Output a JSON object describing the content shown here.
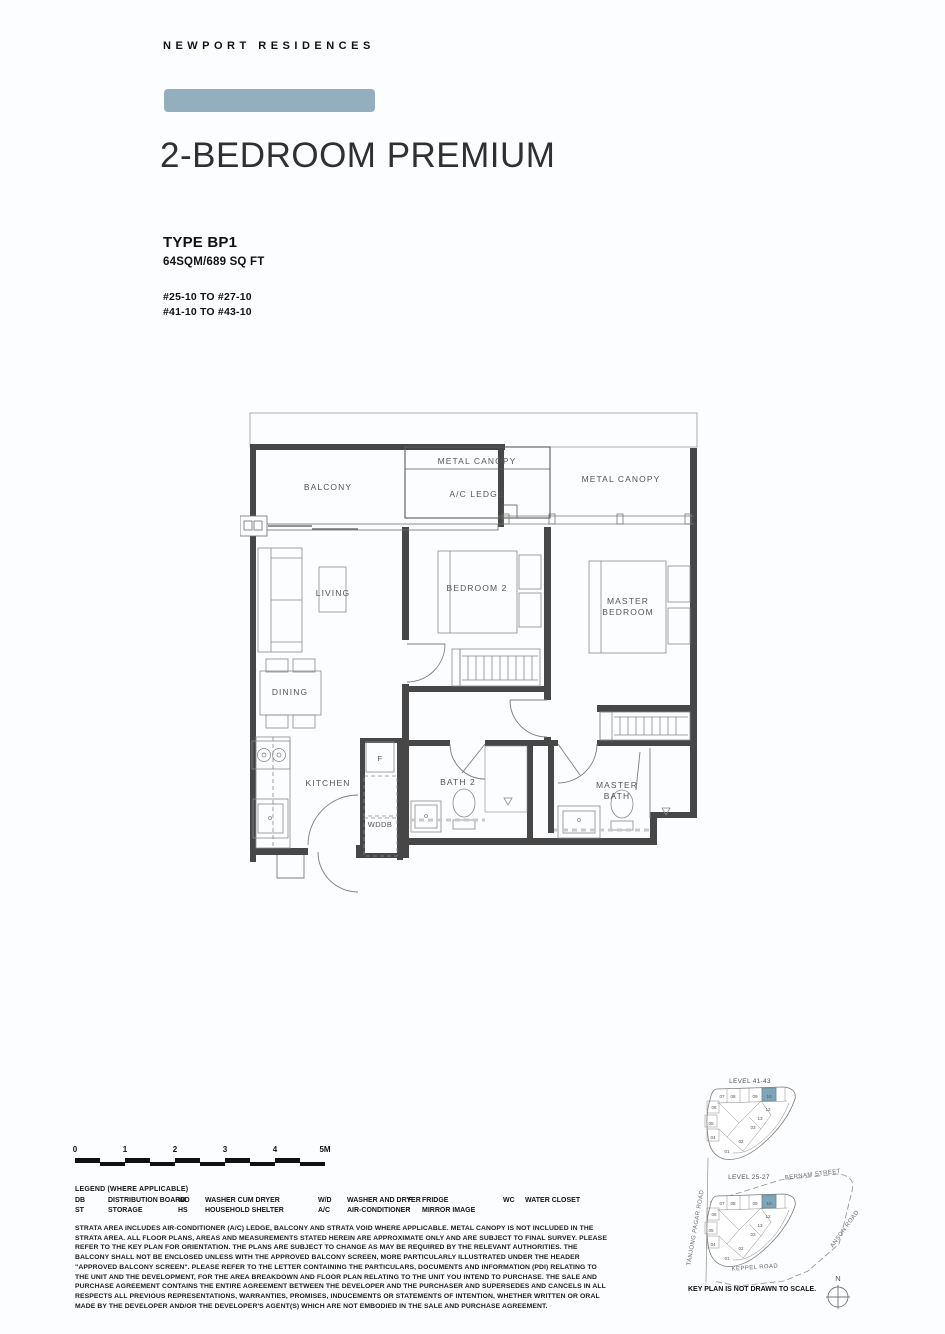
{
  "brand": {
    "name": "NEWPORT RESIDENCES"
  },
  "title": "2-BEDROOM PREMIUM",
  "unit": {
    "type": "TYPE BP1",
    "area": "64SQM/689 SQ FT",
    "stack_lines": [
      "#25-10 TO #27-10",
      "#41-10 TO #43-10"
    ]
  },
  "floorplan": {
    "labels": {
      "metal_canopy_left": "METAL CANOPY",
      "ac_ledge": "A/C LEDGE",
      "metal_canopy_right": "METAL CANOPY",
      "balcony": "BALCONY",
      "living": "LIVING",
      "bedroom2": "BEDROOM 2",
      "master_bedroom_line1": "MASTER",
      "master_bedroom_line2": "BEDROOM",
      "dining": "DINING",
      "kitchen": "KITCHEN",
      "fridge": "F",
      "wddb": "WDDB",
      "bath2": "BATH 2",
      "master_bath_line1": "MASTER",
      "master_bath_line2": "BATH"
    }
  },
  "scalebar": {
    "ticks": [
      "0",
      "1",
      "2",
      "3",
      "4",
      "5M"
    ]
  },
  "legend": {
    "title": "LEGEND (WHERE APPLICABLE)",
    "cols": [
      {
        "rows": [
          {
            "abbr": "DB",
            "label": "DISTRIBUTION BOARD"
          },
          {
            "abbr": "ST",
            "label": "STORAGE"
          }
        ]
      },
      {
        "rows": [
          {
            "abbr": "WD",
            "label": "WASHER CUM DRYER"
          },
          {
            "abbr": "HS",
            "label": "HOUSEHOLD SHELTER"
          }
        ]
      },
      {
        "rows": [
          {
            "abbr": "W/D",
            "label": "WASHER AND DRYER"
          },
          {
            "abbr": "A/C",
            "label": "AIR-CONDITIONER"
          }
        ]
      },
      {
        "rows": [
          {
            "abbr": "F",
            "label": "FRIDGE"
          },
          {
            "abbr": "'",
            "label": "MIRROR IMAGE"
          }
        ]
      },
      {
        "rows": [
          {
            "abbr": "WC",
            "label": "WATER CLOSET"
          }
        ]
      }
    ]
  },
  "disclaimer": "STRATA AREA INCLUDES AIR-CONDITIONER (A/C) LEDGE, BALCONY AND STRATA VOID WHERE APPLICABLE. METAL CANOPY IS NOT INCLUDED IN THE STRATA AREA. ALL FLOOR PLANS, AREAS AND MEASUREMENTS STATED HEREIN ARE APPROXIMATE ONLY AND ARE SUBJECT TO FINAL SURVEY. PLEASE REFER TO THE KEY PLAN FOR ORIENTATION. THE PLANS ARE SUBJECT TO CHANGE AS MAY BE REQUIRED BY THE RELEVANT AUTHORITIES. THE BALCONY SHALL NOT BE ENCLOSED UNLESS WITH THE APPROVED BALCONY SCREEN, MORE PARTICULARLY ILLUSTRATED UNDER THE HEADER \"APPROVED BALCONY SCREEN\". PLEASE REFER TO THE LETTER CONTAINING THE PARTICULARS, DOCUMENTS AND INFORMATION (PDI) RELATING TO THE UNIT AND THE DEVELOPMENT, FOR THE AREA BREAKDOWN AND FLOOR PLAN RELATING TO THE UNIT YOU INTEND TO PURCHASE. THE SALE AND PURCHASE AGREEMENT CONTAINS THE ENTIRE AGREEMENT BETWEEN THE DEVELOPER AND THE PURCHASER AND SUPERSEDES AND CANCELS IN ALL RESPECTS ALL PREVIOUS REPRESENTATIONS, WARRANTIES, PROMISES, INDUCEMENTS OR STATEMENTS OF INTENTION, WHETHER WRITTEN OR ORAL MADE BY THE DEVELOPER AND/OR THE DEVELOPER'S AGENT(S) WHICH ARE NOT EMBODIED IN THE SALE AND PURCHASE AGREEMENT.",
  "keyplan": {
    "levels": {
      "top": "LEVEL 41-43",
      "bottom": "LEVEL 25-27"
    },
    "roads": {
      "bernam": "BERNAM STREET",
      "anson": "ANSON ROAD",
      "keppel": "KEPPEL ROAD",
      "tanjong": "TANJONG PAGAR ROAD"
    },
    "note": "KEY PLAN IS NOT DRAWN TO SCALE.",
    "north": "N",
    "highlighted_unit": "10",
    "highlight_color": "#7da6ba",
    "units": {
      "u01": "01",
      "u02": "02",
      "u03": "03",
      "u04": "04",
      "u05": "05",
      "u06": "06",
      "u07": "07",
      "u08": "08",
      "u09": "09",
      "u10": "10",
      "u12": "12",
      "u13": "13"
    }
  },
  "colors": {
    "banner": "#93aebc",
    "page_bg": "#fbfdfe",
    "wall": "#474747"
  }
}
